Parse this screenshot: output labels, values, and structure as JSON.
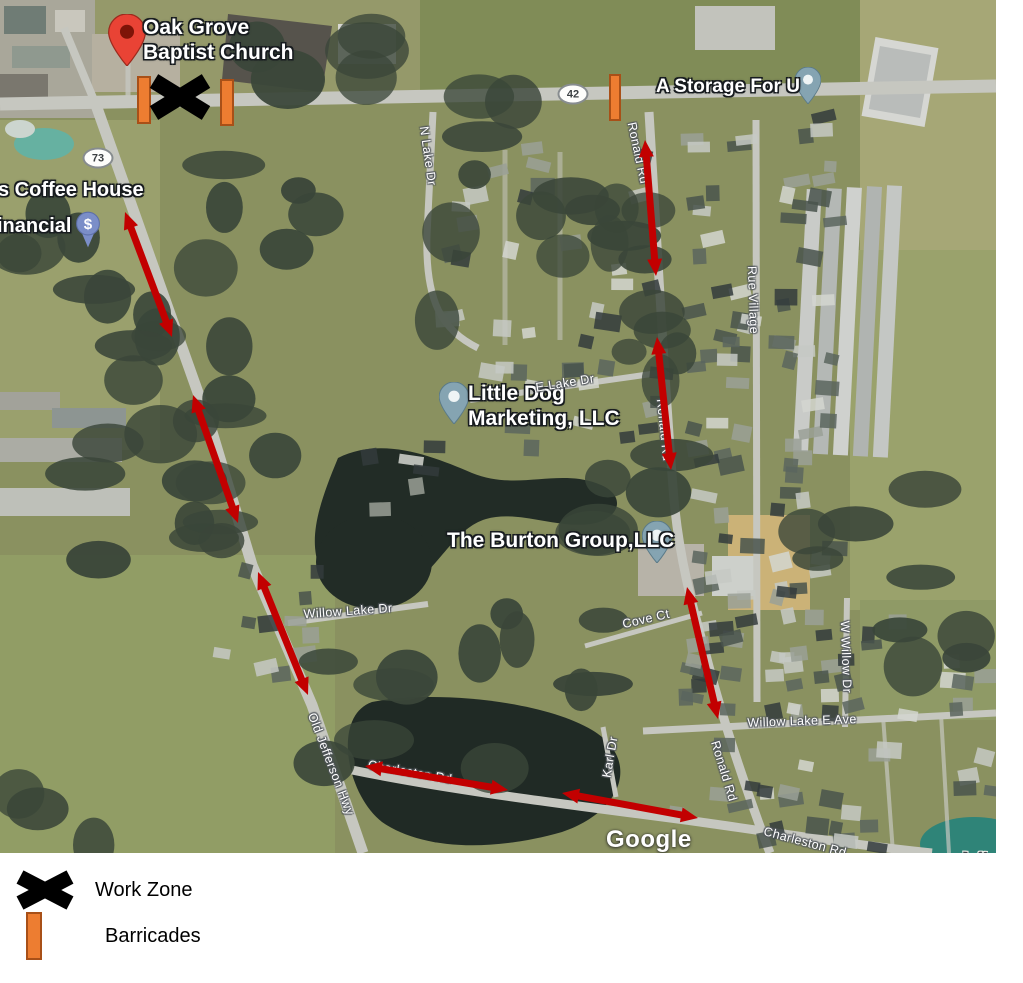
{
  "map": {
    "attribution": "Google",
    "watermark": {
      "text": "Google",
      "x": 606,
      "y": 826
    },
    "pois": [
      {
        "name": "oak-grove-baptist-church",
        "lines": [
          "Oak Grove",
          "Baptist Church"
        ],
        "pin": "red",
        "pin_x": 127,
        "pin_y": 66,
        "pin_w": 38,
        "pin_h": 52,
        "text_x": 143,
        "text_y": 16,
        "size": 21
      },
      {
        "name": "coffee-house",
        "lines": [
          "s Coffee House"
        ],
        "pin": "none",
        "pin_x": 0,
        "pin_y": 0,
        "pin_w": 0,
        "pin_h": 0,
        "text_x": -2,
        "text_y": 179,
        "size": 20
      },
      {
        "name": "financial",
        "lines": [
          "inancial"
        ],
        "pin": "dollar",
        "pin_x": 88,
        "pin_y": 248,
        "pin_w": 26,
        "pin_h": 38,
        "text_x": -3,
        "text_y": 215,
        "size": 20
      },
      {
        "name": "a-storage-for-u",
        "lines": [
          "A Storage For U"
        ],
        "pin": "default",
        "pin_x": 808,
        "pin_y": 104,
        "pin_w": 26,
        "pin_h": 37,
        "text_x": 656,
        "text_y": 76,
        "size": 19
      },
      {
        "name": "little-dog-marketing",
        "lines": [
          "Little Dog",
          "Marketing, LLC"
        ],
        "pin": "default",
        "pin_x": 454,
        "pin_y": 424,
        "pin_w": 30,
        "pin_h": 42,
        "text_x": 468,
        "text_y": 382,
        "size": 21
      },
      {
        "name": "the-burton-group",
        "lines": [
          "The Burton Group,LLC"
        ],
        "pin": "default",
        "pin_x": 657,
        "pin_y": 563,
        "pin_w": 30,
        "pin_h": 42,
        "text_x": 447,
        "text_y": 529,
        "size": 21
      }
    ],
    "route_shields": [
      {
        "text": "73",
        "x": 98,
        "y": 158
      },
      {
        "text": "42",
        "x": 573,
        "y": 94
      }
    ],
    "road_labels": [
      {
        "text": "N Lake Dr",
        "x": 428,
        "y": 156,
        "rot": 82
      },
      {
        "text": "Ronald Rd",
        "x": 638,
        "y": 153,
        "rot": 78
      },
      {
        "text": "Rue Village",
        "x": 753,
        "y": 300,
        "rot": 88
      },
      {
        "text": "Ronald Rd",
        "x": 664,
        "y": 430,
        "rot": 84
      },
      {
        "text": "E Lake Dr",
        "x": 565,
        "y": 383,
        "rot": -9
      },
      {
        "text": "Willow Lake Dr",
        "x": 348,
        "y": 611,
        "rot": -4
      },
      {
        "text": "Cove Ct",
        "x": 646,
        "y": 619,
        "rot": -13
      },
      {
        "text": "W Willow Dr",
        "x": 846,
        "y": 657,
        "rot": 88
      },
      {
        "text": "Willow Lake E Ave",
        "x": 802,
        "y": 721,
        "rot": -2
      },
      {
        "text": "Karl Dr",
        "x": 610,
        "y": 757,
        "rot": -80
      },
      {
        "text": "Old Jefferson Hwy",
        "x": 331,
        "y": 764,
        "rot": 69
      },
      {
        "text": "Charleston Rd",
        "x": 410,
        "y": 772,
        "rot": 10
      },
      {
        "text": "Ronald Rd",
        "x": 724,
        "y": 771,
        "rot": 73
      },
      {
        "text": "Charleston Rd",
        "x": 805,
        "y": 842,
        "rot": 15
      }
    ],
    "city_labels": [
      {
        "text": "Jefferson",
        "x": 960,
        "y": 850,
        "rot": 2
      }
    ],
    "annotations": {
      "arrow_color": "#c20000",
      "barricade_fill": "#ed7d31",
      "barricade_border": "#a85018",
      "work_zone_color": "#000000",
      "arrows": [
        {
          "x1": 125,
          "y1": 212,
          "x2": 172,
          "y2": 337
        },
        {
          "x1": 193,
          "y1": 395,
          "x2": 238,
          "y2": 523
        },
        {
          "x1": 258,
          "y1": 572,
          "x2": 308,
          "y2": 695
        },
        {
          "x1": 645,
          "y1": 140,
          "x2": 656,
          "y2": 276
        },
        {
          "x1": 657,
          "y1": 337,
          "x2": 671,
          "y2": 470
        },
        {
          "x1": 687,
          "y1": 587,
          "x2": 718,
          "y2": 719
        },
        {
          "x1": 365,
          "y1": 766,
          "x2": 508,
          "y2": 790
        },
        {
          "x1": 562,
          "y1": 793,
          "x2": 698,
          "y2": 818
        }
      ],
      "barricades": [
        {
          "x": 137,
          "y": 76,
          "w": 14,
          "h": 48
        },
        {
          "x": 220,
          "y": 79,
          "w": 14,
          "h": 47
        },
        {
          "x": 609,
          "y": 74,
          "w": 12,
          "h": 47
        }
      ],
      "work_zones": [
        {
          "cx": 180,
          "cy": 97,
          "w": 62,
          "h": 50
        }
      ]
    }
  },
  "legend": {
    "items": [
      {
        "icon": "work-zone-x-icon",
        "label": "Work Zone"
      },
      {
        "icon": "barricade-icon",
        "label": "Barricades"
      }
    ]
  }
}
